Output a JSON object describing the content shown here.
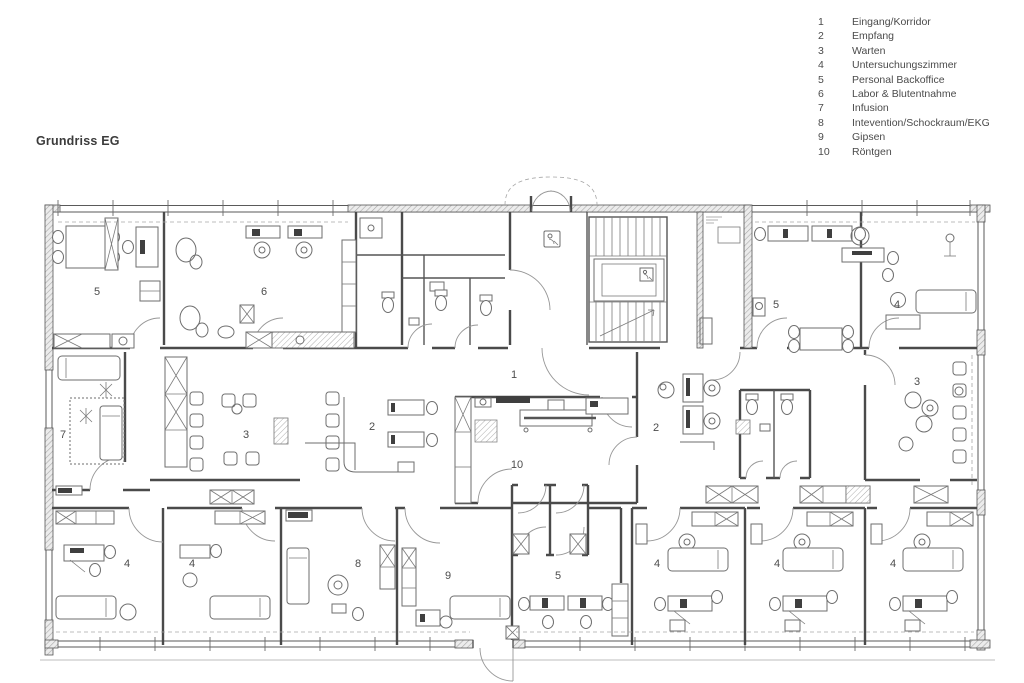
{
  "title": "Grundriss EG",
  "legend": {
    "items": [
      {
        "num": "1",
        "label": "Eingang/Korridor"
      },
      {
        "num": "2",
        "label": "Empfang"
      },
      {
        "num": "3",
        "label": "Warten"
      },
      {
        "num": "4",
        "label": "Untersuchungszimmer"
      },
      {
        "num": "5",
        "label": "Personal Backoffice"
      },
      {
        "num": "6",
        "label": "Labor & Blutentnahme"
      },
      {
        "num": "7",
        "label": "Infusion"
      },
      {
        "num": "8",
        "label": "Intevention/Schockraum/EKG"
      },
      {
        "num": "9",
        "label": "Gipsen"
      },
      {
        "num": "10",
        "label": "Röntgen"
      }
    ]
  },
  "plan": {
    "room_labels": [
      {
        "num": "5",
        "x": 97,
        "y": 291
      },
      {
        "num": "6",
        "x": 264,
        "y": 291
      },
      {
        "num": "5",
        "x": 776,
        "y": 304
      },
      {
        "num": "4",
        "x": 897,
        "y": 304
      },
      {
        "num": "7",
        "x": 63,
        "y": 434
      },
      {
        "num": "3",
        "x": 246,
        "y": 434
      },
      {
        "num": "2",
        "x": 372,
        "y": 426
      },
      {
        "num": "1",
        "x": 514,
        "y": 374
      },
      {
        "num": "10",
        "x": 517,
        "y": 464
      },
      {
        "num": "2",
        "x": 656,
        "y": 427
      },
      {
        "num": "3",
        "x": 917,
        "y": 381
      },
      {
        "num": "4",
        "x": 127,
        "y": 563
      },
      {
        "num": "4",
        "x": 192,
        "y": 563
      },
      {
        "num": "8",
        "x": 358,
        "y": 563
      },
      {
        "num": "9",
        "x": 448,
        "y": 575
      },
      {
        "num": "5",
        "x": 558,
        "y": 575
      },
      {
        "num": "4",
        "x": 657,
        "y": 563
      },
      {
        "num": "4",
        "x": 777,
        "y": 563
      },
      {
        "num": "4",
        "x": 893,
        "y": 563
      }
    ]
  }
}
